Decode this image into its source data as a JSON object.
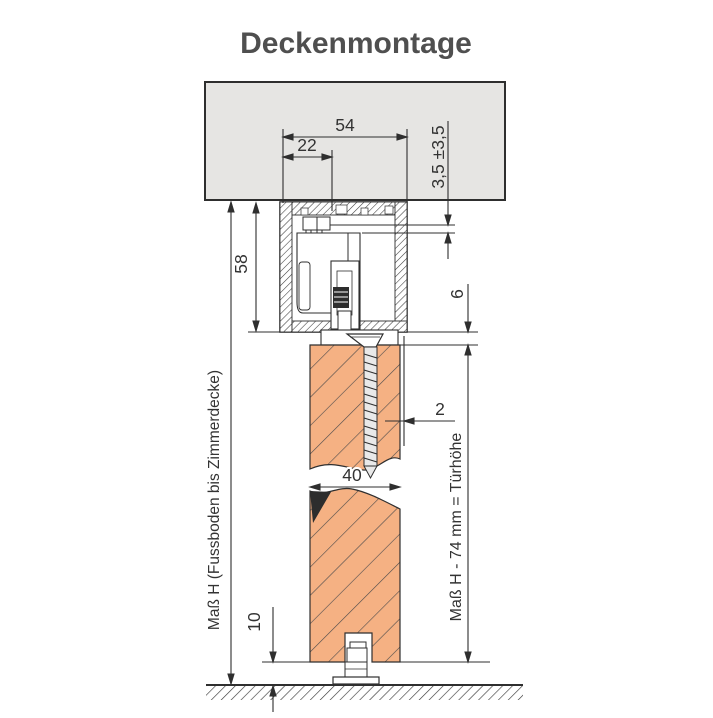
{
  "title": "Deckenmontage",
  "labels": {
    "left_vertical": "Maß H (Fussboden bis Zimmerdecke)",
    "right_vertical": "Maß H - 74 mm = Türhöhe"
  },
  "dimensions": {
    "rail_width_mm": "54",
    "fixing_offset_mm": "22",
    "adjustment_mm": "3,5 ±3,5",
    "rail_height_mm": "58",
    "rail_to_door_gap_mm": "6",
    "door_offset_mm": "2",
    "door_thickness_mm": "40",
    "floor_clearance_mm": "10"
  },
  "colors": {
    "ceiling_fill": "#e6e5e3",
    "door_wood_fill": "#f5b183",
    "drawing_line": "#333333",
    "title_text": "#4f4f4f"
  }
}
